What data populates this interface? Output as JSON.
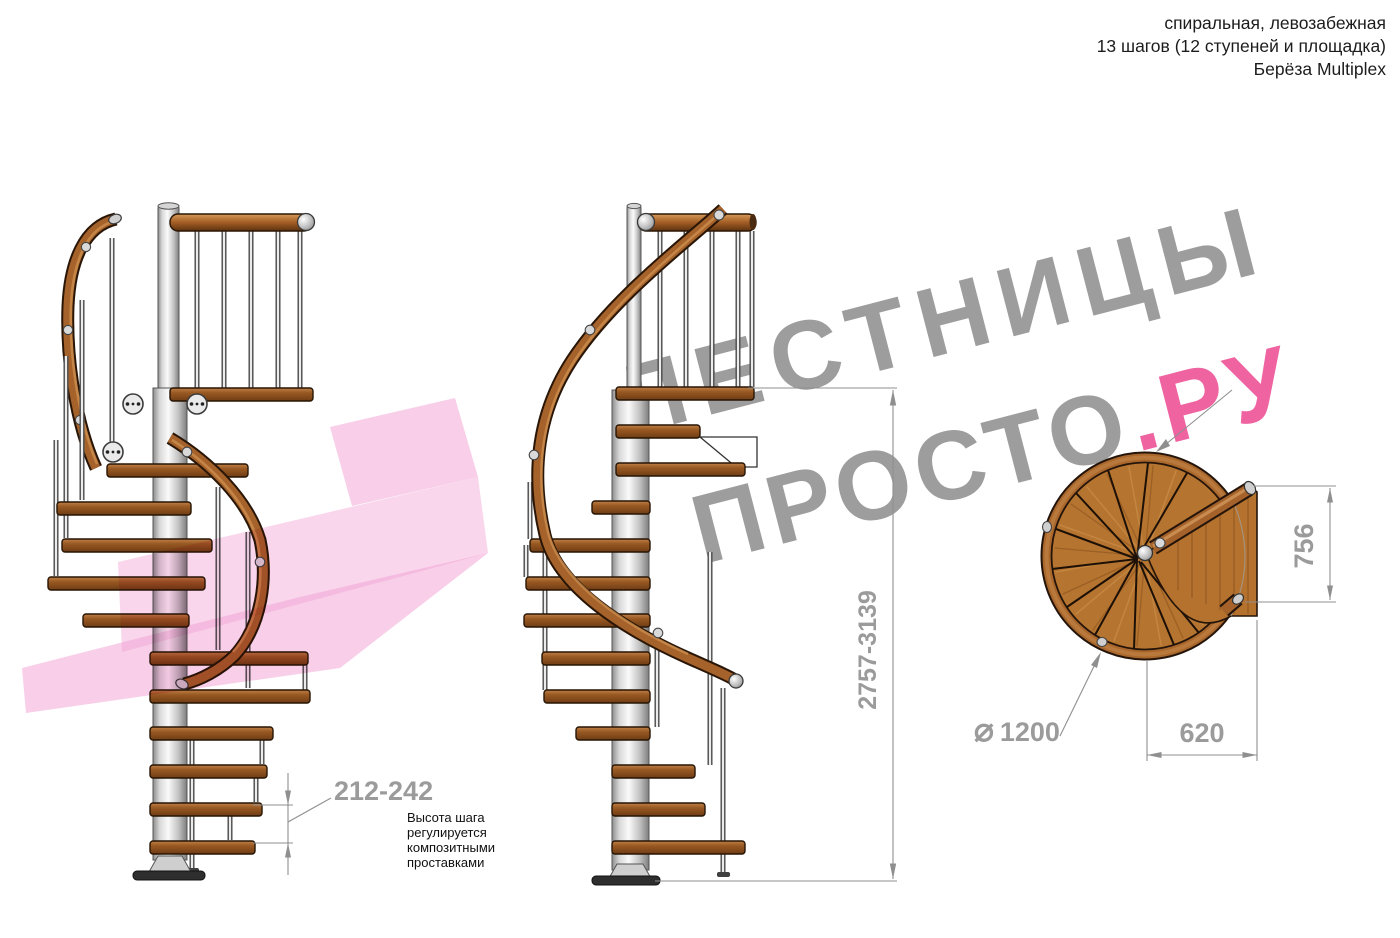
{
  "header": {
    "lines": [
      "спиральная, левозабежная",
      "13 шагов (12 ступеней и площадка)",
      "Берёза Multiplex"
    ]
  },
  "watermark": {
    "line1": "ЛЕСТНИЦЫ",
    "line2_gray": "ПРОСТО",
    "line2_pink": ".РУ"
  },
  "dimensions": {
    "step_height": "212-242",
    "step_height_note": "Высота шага\nрегулируется\nкомпозитными\nпроставками",
    "total_height": "2757-3139",
    "platform_depth": "756",
    "platform_width": "620",
    "diameter_symbol": "⌀",
    "diameter_value": "1200"
  },
  "colors": {
    "wood": "#a5622b",
    "wood_outline": "#24140a",
    "metal": "#d9d9d9",
    "watermark_gray": "#9d9d9d",
    "watermark_pink": "#ef63a1",
    "logo_pink": "#f19ed2",
    "dimension_gray": "#9b9b9b"
  }
}
